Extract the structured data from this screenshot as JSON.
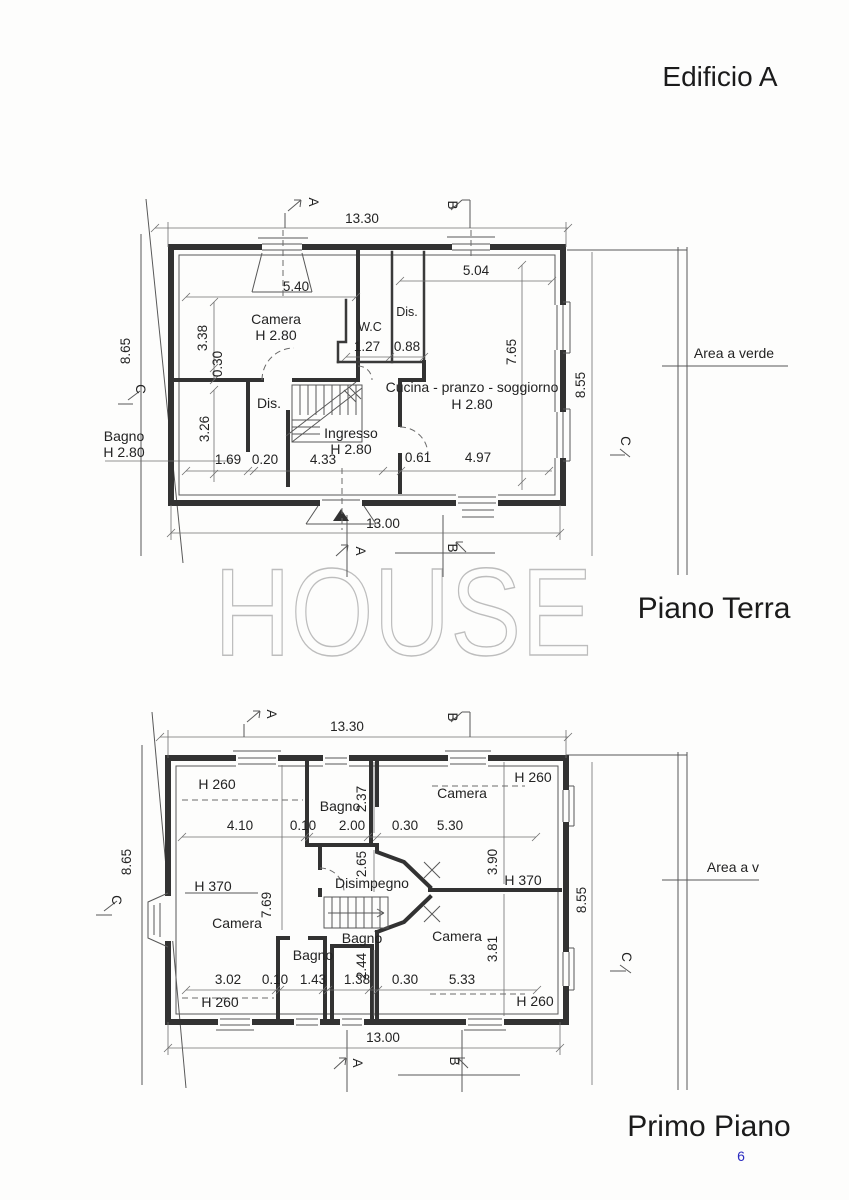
{
  "page": {
    "title": "Edificio A",
    "watermark": "HOUSE",
    "page_number": "6",
    "colors": {
      "ink": "#323232",
      "dim_line": "#585858",
      "watermark": "#bdbdbd",
      "page_number": "#2b2bc0",
      "paper": "#fdfdfc"
    }
  },
  "gf": {
    "caption": "Piano Terra",
    "area_note": "Area a verde",
    "rooms": {
      "camera": {
        "label": "Camera",
        "height": "H 2.80"
      },
      "wc": {
        "label": "W.C"
      },
      "dis_top": {
        "label": "Dis."
      },
      "dis_mid": {
        "label": "Dis."
      },
      "bagno": {
        "label": "Bagno",
        "height": "H 2.80"
      },
      "ingresso": {
        "label": "Ingresso",
        "height": "H 2.80"
      },
      "cucina": {
        "label": "Cucina - pranzo - soggiorno",
        "height": "H 2.80"
      }
    },
    "dims": {
      "total_top": "13.30",
      "camera_width": "5.40",
      "cucina_width": "5.04",
      "camera_depth": "3.38",
      "wall": "0.30",
      "bagno_depth": "3.26",
      "wc_width": "1.27",
      "dis_width": "0.88",
      "bagno_width": "1.69",
      "wall2": "0.20",
      "ingresso_width": "4.33",
      "wall3": "0.61",
      "cucina_width2": "4.97",
      "cucina_depth": "7.65",
      "left_total": "8.65",
      "right_total": "8.55",
      "total_bottom": "13.00"
    },
    "markers": {
      "a": "A",
      "b": "B",
      "c": "C"
    }
  },
  "ff": {
    "caption": "Primo Piano",
    "area_note": "Area a v",
    "rooms": {
      "camera_left": {
        "label": "Camera"
      },
      "camera_top_right": {
        "label": "Camera"
      },
      "camera_bottom_right": {
        "label": "Camera"
      },
      "bagno_top": {
        "label": "Bagno"
      },
      "bagno_bottom_left": {
        "label": "Bagno"
      },
      "bagno_middle": {
        "label": "Bagno"
      },
      "disimpegno": {
        "label": "Disimpegno"
      }
    },
    "heights": {
      "attic": "H 260",
      "ridge": "H 370"
    },
    "dims": {
      "total_top": "13.30",
      "row_top": [
        "4.10",
        "0.10",
        "2.00",
        "0.30",
        "5.30"
      ],
      "bagno_top_depth": "2.37",
      "disimpegno_depth": "2.65",
      "camera_tr_depth": "3.90",
      "camera_left_depth": "7.69",
      "bagno_mid_depth": "2.44",
      "camera_br_depth": "3.81",
      "row_bottom": [
        "3.02",
        "0.10",
        "1.43",
        "1.38",
        "0.30",
        "5.33"
      ],
      "total_bottom": "13.00",
      "left_total": "8.65",
      "right_total": "8.55"
    },
    "markers": {
      "a": "A",
      "b": "B",
      "c": "C"
    }
  }
}
